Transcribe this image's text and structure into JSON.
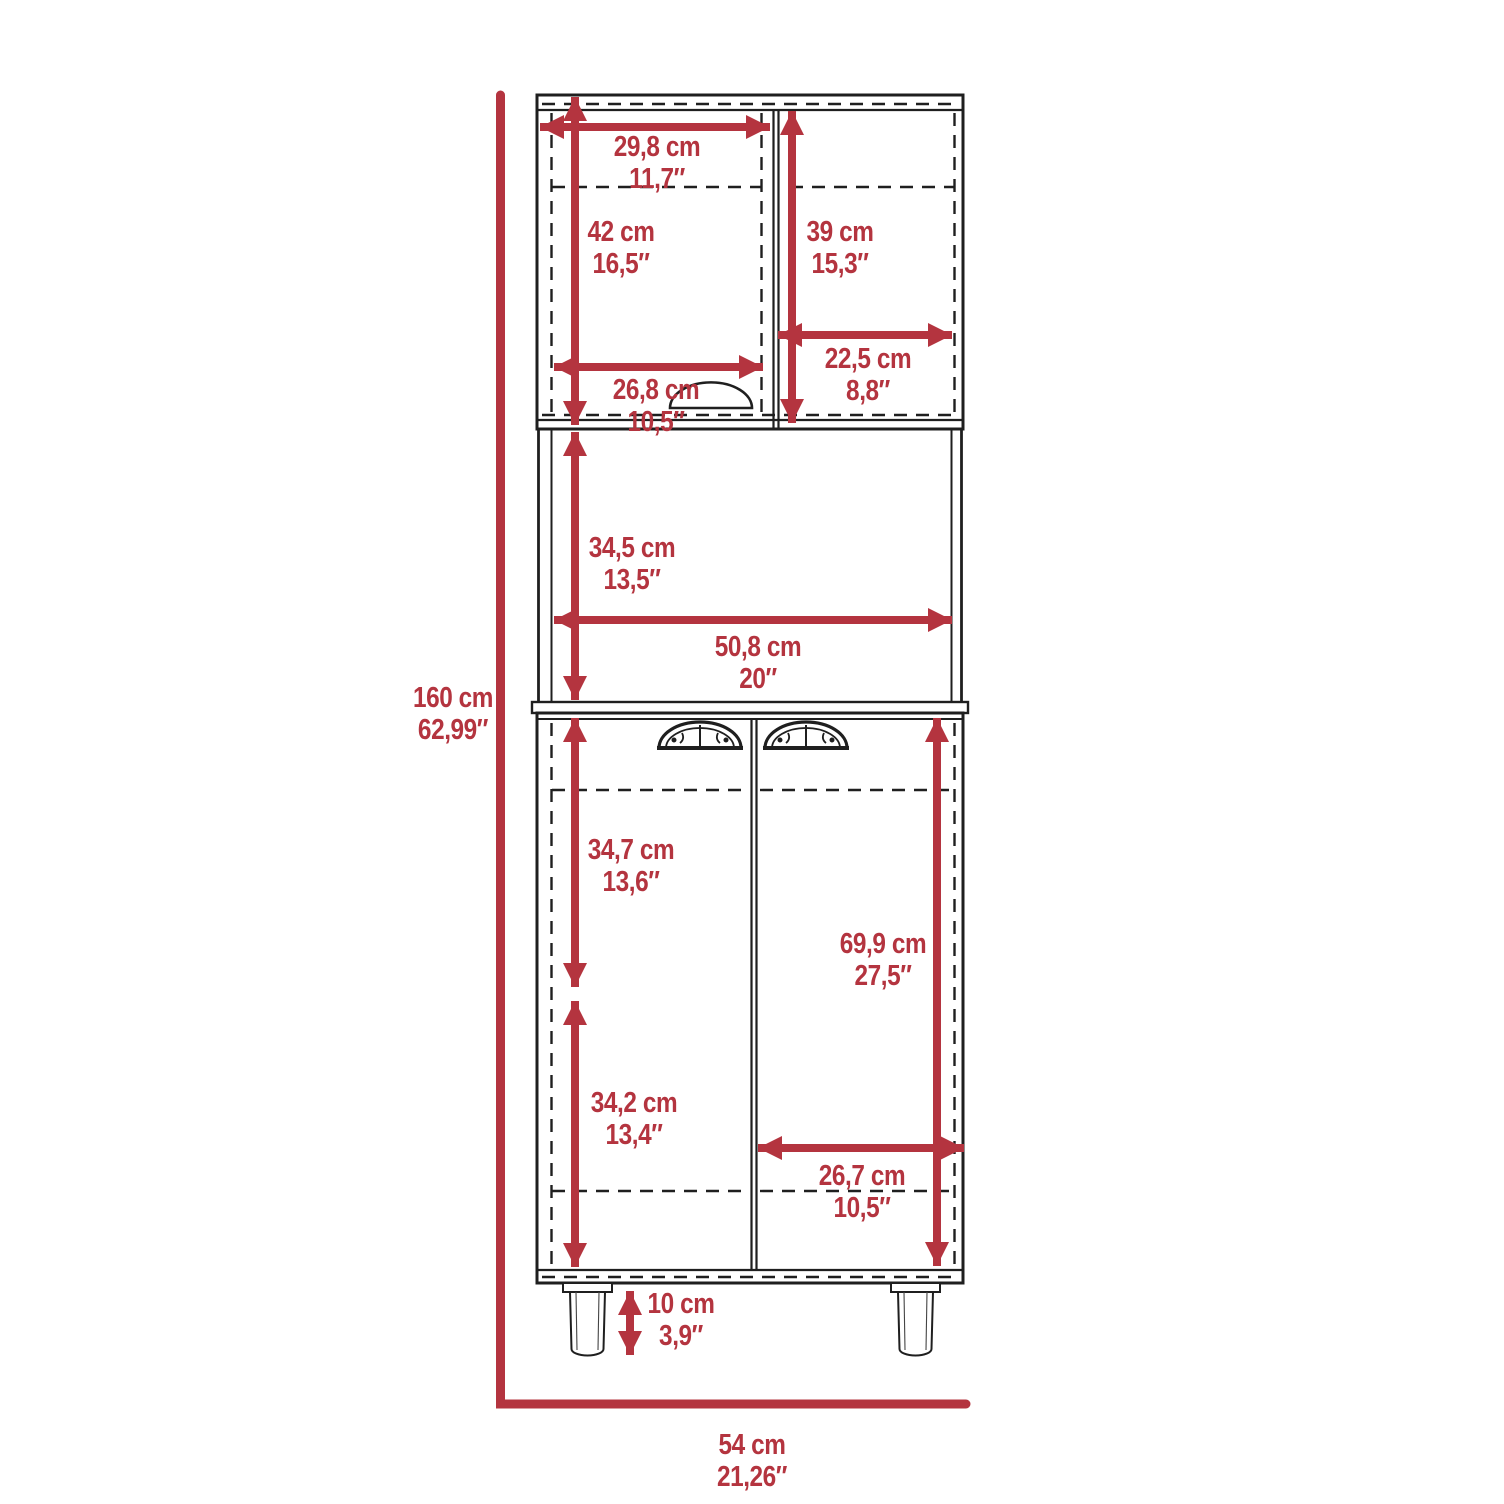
{
  "diagram": {
    "type": "furniture-dimension-drawing",
    "subject": "tall-2-door-pantry-cabinet-front-view",
    "accent_color": "#b4343f",
    "line_color": "#1f1f1f",
    "units": [
      "cm",
      "in"
    ],
    "dims": {
      "upper_left_width": {
        "cm": "29,8 cm",
        "in": "11,7″"
      },
      "upper_left_height": {
        "cm": "42 cm",
        "in": "16,5″"
      },
      "upper_right_height": {
        "cm": "39 cm",
        "in": "15,3″"
      },
      "upper_right_width": {
        "cm": "22,5 cm",
        "in": "8,8″"
      },
      "upper_shelf_width": {
        "cm": "26,8 cm",
        "in": "10,5″"
      },
      "middle_height": {
        "cm": "34,5 cm",
        "in": "13,5″"
      },
      "middle_width": {
        "cm": "50,8 cm",
        "in": "20″"
      },
      "total_height": {
        "cm": "160 cm",
        "in": "62,99″"
      },
      "lower_upper_height": {
        "cm": "34,7 cm",
        "in": "13,6″"
      },
      "lower_door_height": {
        "cm": "69,9 cm",
        "in": "27,5″"
      },
      "lower_lower_height": {
        "cm": "34,2 cm",
        "in": "13,4″"
      },
      "lower_right_width": {
        "cm": "26,7 cm",
        "in": "10,5″"
      },
      "leg_height": {
        "cm": "10 cm",
        "in": "3,9″"
      },
      "total_width": {
        "cm": "54 cm",
        "in": "21,26″"
      }
    }
  }
}
